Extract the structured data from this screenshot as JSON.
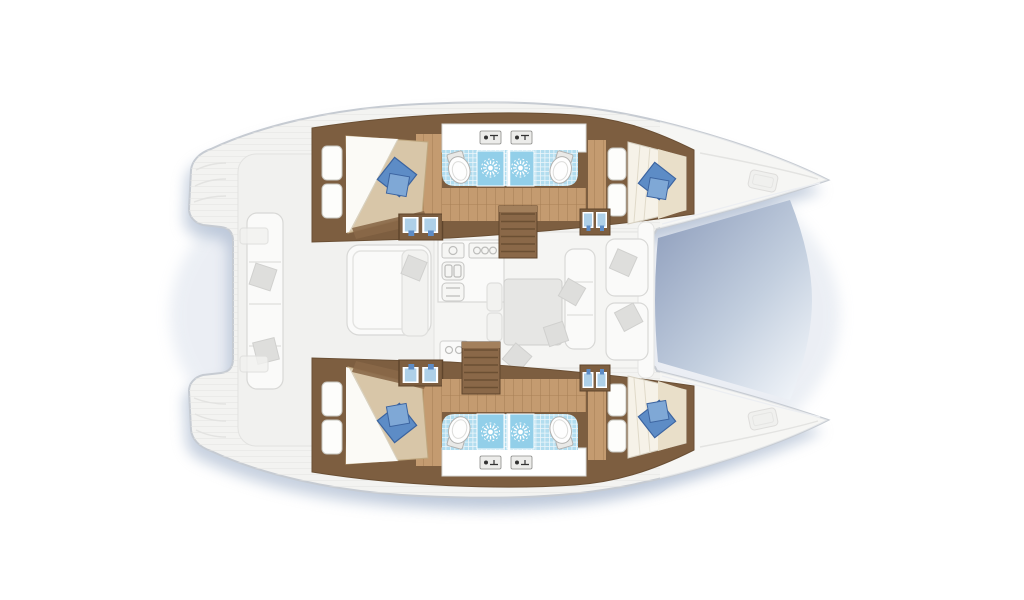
{
  "document": {
    "title": "Catamaran accommodation plan",
    "view": "Top-down deck plan, bows to the right, lower-deck cabins highlighted, main deck faded",
    "background": "#ffffff"
  },
  "palette": {
    "deck": "#f3f3f1",
    "deck_line": "#c6cbd2",
    "shadow": "#8fa3c0",
    "wood_dark": "#7d5e40",
    "wood_floor": "#c49b70",
    "stair_wood": "#8a6848",
    "tile_blue": "#b2ddef",
    "shower_blue": "#92cfe9",
    "bed_beige": "#d8c6a8",
    "bed_white": "#f6f2e8",
    "blanket_beige": "#e9dfc9",
    "pillow_blue": "#5d8cc6",
    "pillow_blue_light": "#7fa8d6",
    "trampoline_dark": "#97a6c2",
    "trampoline_mid": "#c3cfdf",
    "trampoline_light": "#eff3f8"
  },
  "rooms": {
    "boat": {
      "label": "Catamaran floor plan"
    },
    "cockpit": {
      "label": "Aft cockpit"
    },
    "cockpit_table": {
      "label": "Cockpit table"
    },
    "cockpit_bench": {
      "label": "Cockpit bench seating"
    },
    "salon": {
      "label": "Salon and galley"
    },
    "galley": {
      "label": "Galley with stove and sink"
    },
    "dinette": {
      "label": "Dinette table and sofa"
    },
    "foredeck_seats": {
      "label": "Forward cockpit seats"
    },
    "trampoline": {
      "label": "Bow trampoline"
    },
    "hull_top": {
      "label": "Port hull accommodations"
    },
    "hull_bottom": {
      "label": "Starboard hull accommodations"
    },
    "aft_cabin": {
      "label": "Aft double cabin"
    },
    "fwd_cabin": {
      "label": "Forward double cabin"
    },
    "aft_heads": {
      "label": "Aft bathroom with shower"
    },
    "fwd_heads": {
      "label": "Forward bathroom with shower"
    },
    "stairs_top": {
      "label": "Port companionway stairs"
    },
    "stairs_bottom": {
      "label": "Starboard companionway stairs"
    },
    "bow_deck": {
      "label": "Bow deck with hatch"
    },
    "transom": {
      "label": "Stern transom platform"
    }
  },
  "legend": {
    "cabins": 4,
    "bathrooms": 4,
    "showers": 4,
    "toilets": 4,
    "berths": "4 double beds"
  }
}
